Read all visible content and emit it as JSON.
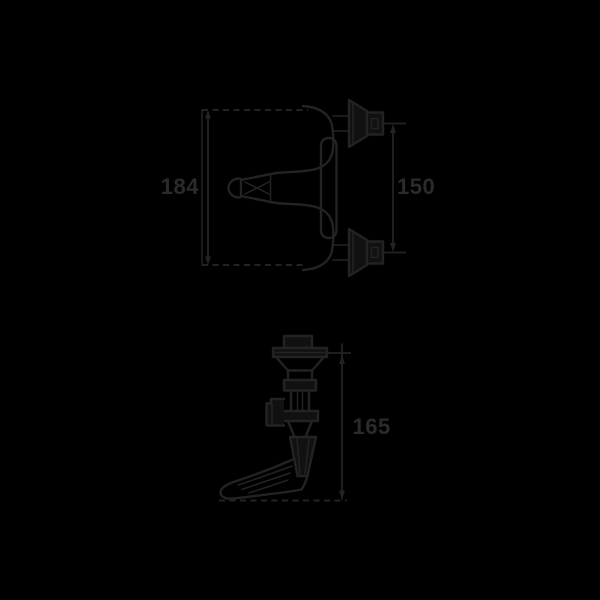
{
  "colors": {
    "background": "#000000",
    "line": "#232323",
    "label": "#2b2b2b"
  },
  "top_view": {
    "dim_height": {
      "value": "184"
    },
    "dim_connections": {
      "value": "150"
    }
  },
  "side_view": {
    "dim_height": {
      "value": "165"
    }
  }
}
